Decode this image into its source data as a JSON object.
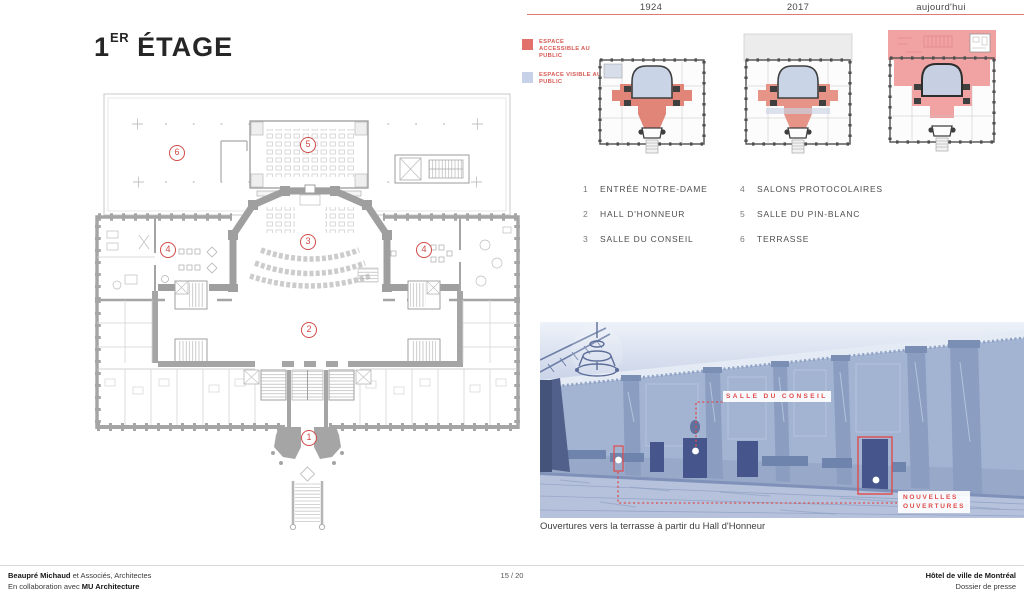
{
  "title": {
    "number": "1",
    "ordinal": "ER",
    "word": "ÉTAGE"
  },
  "timeline": {
    "years": [
      "1924",
      "2017",
      "aujourd'hui"
    ]
  },
  "legend": {
    "items": [
      {
        "label": "ESPACE ACCESSIBLE AU PUBLIC",
        "color": "#e2706b"
      },
      {
        "label": "ESPACE VISIBLE AU PUBLIC",
        "color": "#c7d2e9"
      }
    ]
  },
  "rooms": [
    {
      "num": "1",
      "label": "ENTRÉE NOTRE-DAME"
    },
    {
      "num": "2",
      "label": "HALL D'HONNEUR"
    },
    {
      "num": "3",
      "label": "SALLE DU CONSEIL"
    },
    {
      "num": "4",
      "label": "SALONS PROTOCOLAIRES"
    },
    {
      "num": "5",
      "label": "SALLE DU PIN-BLANC"
    },
    {
      "num": "6",
      "label": "TERRASSE"
    }
  ],
  "photo": {
    "label_salle_du_conseil": "SALLE DU CONSEIL",
    "label_nouvelles_line1": "NOUVELLES",
    "label_nouvelles_line2": "OUVERTURES",
    "caption": "Ouvertures vers la terrasse à partir du Hall d'Honneur"
  },
  "footer": {
    "firm_bold": "Beaupré Michaud",
    "firm_rest": " et Associés, Architectes",
    "collab_prefix": "En collaboration avec ",
    "collab_bold": "MU Architecture",
    "page": "15 / 20",
    "project_bold": "Hôtel de ville de Montréal",
    "project_sub": "Dossier de presse"
  },
  "colors": {
    "accent_red": "#cf4a47",
    "annotation_red": "#e04b4b",
    "legend_red": "#e2706b",
    "legend_blue": "#c7d2e9",
    "plan_salmon": "#e08577",
    "plan_pink": "#f1a3a3",
    "plan_blue": "#c9d4e7",
    "photo_blue": "#a7b8d6"
  }
}
